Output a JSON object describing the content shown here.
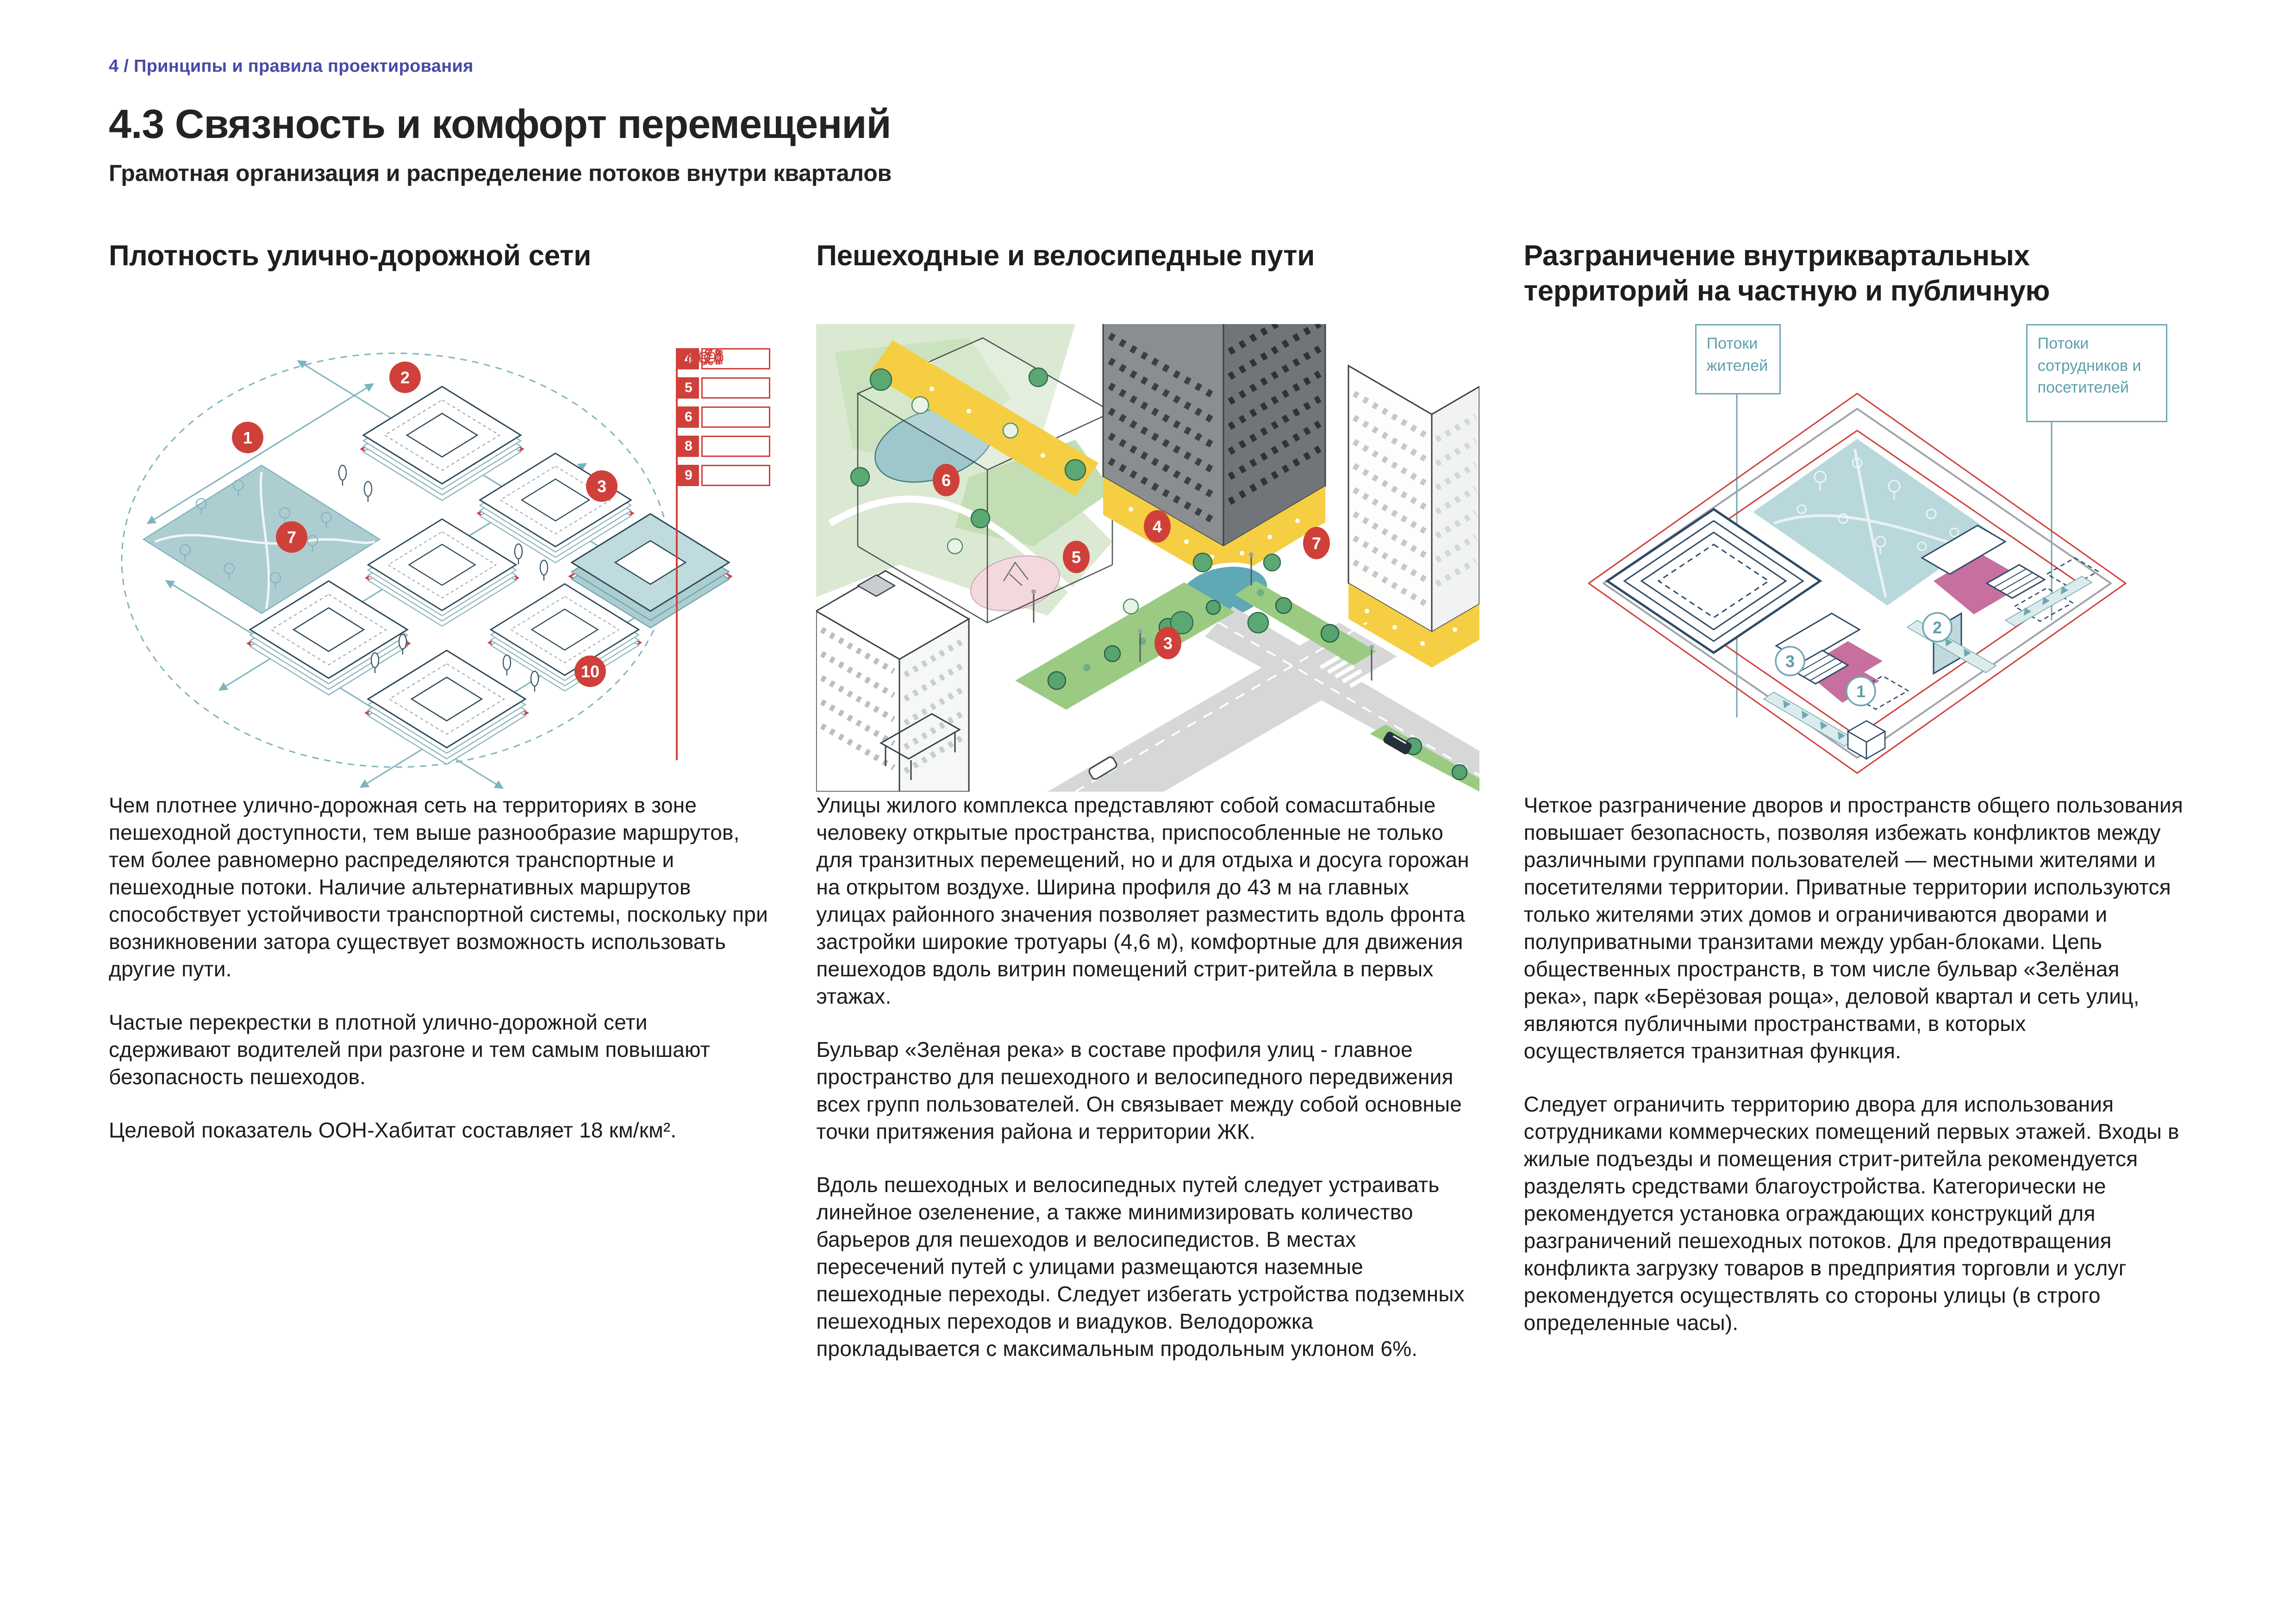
{
  "header": {
    "breadcrumb": "4 / Принципы и правила проектирования",
    "title": "4.3 Связность и комфорт перемещений",
    "subtitle": "Грамотная организация и распределение потоков внутри кварталов"
  },
  "colors": {
    "accent_blue": "#4749A6",
    "accent_red": "#D0403B",
    "accent_teal": "#6FA8B3",
    "park_teal_fill": "#AECDD0",
    "courtyard_pink": "#C76F9F",
    "retail_yellow": "#F6CE43",
    "lawn_green": "#9BCB83"
  },
  "columns": [
    {
      "heading": "Плотность улично-дорожной сети",
      "paragraphs": [
        "Чем плотнее улично-дорожная сеть на территориях в зоне пешеходной доступности, тем выше разнообразие маршрутов, тем более равномерно распределяются транспортные и пешеходные потоки. Наличие альтернативных маршрутов способствует устойчивости транспортной системы, поскольку при возникновении затора существует возможность использовать другие пути.",
        "Частые перекрестки в плотной улично-дорожной сети сдерживают водителей при разгоне и тем самым повышают безопасность пешеходов.",
        "Целевой показатель ООН-Хабитат составляет 18 км/км²."
      ]
    },
    {
      "heading": "Пешеходные и велосипедные пути",
      "paragraphs": [
        "Улицы жилого комплекса представляют собой сомасштабные человеку открытые пространства, приспособленные не только для транзитных перемещений, но и для отдыха и досуга горожан на открытом воздухе. Ширина профиля до 43 м на главных улицах районного значения позволяет разместить вдоль фронта застройки широкие тротуары (4,6 м), комфортные для движения пешеходов вдоль витрин помещений стрит-ритейла в первых этажах.",
        "Бульвар «Зелёная река» в составе профиля улиц - главное пространство для пешеходного и велосипедного передвижения всех групп пользователей. Он связывает между собой основные точки притяжения района и территории ЖК.",
        "Вдоль пешеходных и велосипедных путей следует устраивать линейное озеленение, а также минимизировать количество барьеров для пешеходов и велосипедистов. В местах пересечений путей с улицами размещаются наземные пешеходные переходы. Следует избегать устройства подземных пешеходных переходов и виадуков. Велодорожка прокладывается с максимальным продольным уклоном 6%."
      ]
    },
    {
      "heading": "Разграничение внутриквартальных территорий на частную и публичную",
      "paragraphs": [
        "Четкое разграничение дворов и пространств общего пользования повышает безопасность, позволяя избежать конфликтов между различными группами пользователей — местными жителями и посетителями территории. Приватные территории используются только жителями этих домов и ограничиваются дворами и полуприватными транзитами между урбан-блоками. Цепь общественных пространств, в том числе бульвар «Зелёная река», парк «Берёзовая роща», деловой квартал и сеть улиц, являются публичными пространствами, в которых осуществляется транзитная функция.",
        "Следует ограничить территорию двора для использования сотрудниками коммерческих помещений первых этажей. Входы в жилые подъезды и помещения стрит-ритейла рекомендуется разделять средствами благоустройства. Категорически не рекомендуется установка ограждающих конструкций для разграничений пешеходных потоков. Для предотвращения конфликта загрузку товаров в предприятия торговли и услуг рекомендуется осуществлять со стороны улицы (в строго определенные часы)."
      ]
    }
  ],
  "figure1": {
    "markers": {
      "m1": "1",
      "m2": "2",
      "m3": "3",
      "m7": "7",
      "m10": "10"
    },
    "legend": [
      {
        "num": "4",
        "icon": "house-person"
      },
      {
        "num": "5",
        "icon": "people"
      },
      {
        "num": "6",
        "icon": "tree-person"
      },
      {
        "num": "8",
        "icon": "parking-person",
        "icon_text": "P"
      },
      {
        "num": "9",
        "icon": "tram"
      }
    ]
  },
  "figure2": {
    "markers": {
      "m3": "3",
      "m4": "4",
      "m5": "5",
      "m6": "6",
      "m7": "7"
    }
  },
  "figure3": {
    "flows_residents": "Потоки жителей",
    "flows_staff": "Потоки сотрудников и посетителей",
    "markers": {
      "m1": "1",
      "m2": "2",
      "m3": "3"
    }
  }
}
